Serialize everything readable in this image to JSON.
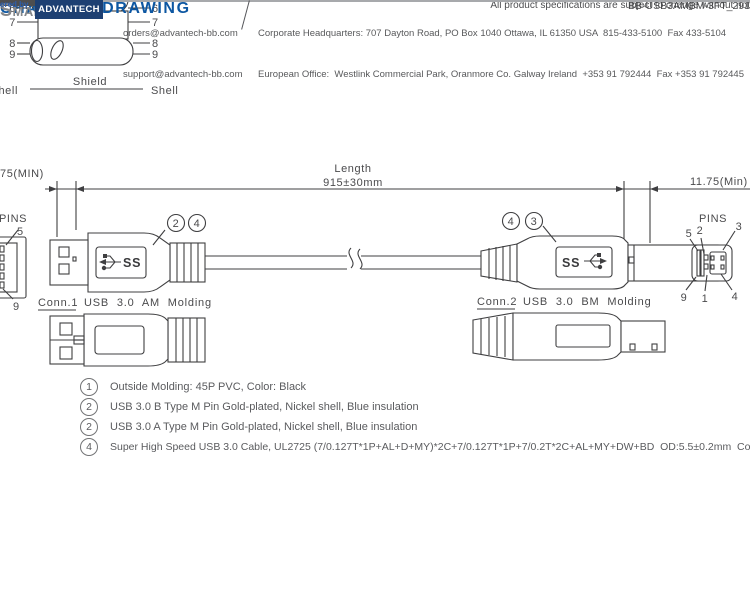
{
  "colors": {
    "heading_blue": "#0d57a2",
    "drawing_line": "#3f3f41",
    "note_text": "#5a5b5e",
    "footer_text": "#58595b",
    "brand_gray": "#85878a",
    "advantech_blue": "#1d3f72",
    "powered_by_blue": "#2c5fae"
  },
  "wiring": {
    "left_pins": [
      "6",
      "7",
      "8",
      "9"
    ],
    "right_pins": [
      "6",
      "7",
      "8",
      "9"
    ],
    "shell_left": "hell",
    "shield_label": "Shield",
    "shell_right": "Shell"
  },
  "header": {
    "title": "CHANICAL DRAWING",
    "unit": "t: mm"
  },
  "dims": {
    "left_min": "75(MIN)",
    "length_label": "Length",
    "length_value": "915±30mm",
    "right_min": "11.75(Min)"
  },
  "conn1": {
    "pins_label": "PINS",
    "pin_top": "5",
    "pin_bottom": "9",
    "callout_a": "2",
    "callout_b": "4",
    "logo": "SS",
    "name": "Conn.1",
    "desc": "USB 3.0 AM Molding"
  },
  "conn2": {
    "pins_label": "PINS",
    "pin_t1": "5",
    "pin_t2": "2",
    "pin_t3": "3",
    "pin_b1": "9",
    "pin_b2": "1",
    "pin_b3": "4",
    "callout_a": "4",
    "callout_b": "3",
    "logo": "SS",
    "name": "Conn.2",
    "desc": "USB 3.0 BM Molding"
  },
  "notes": [
    {
      "num": "1",
      "text": "Outside Molding: 45P PVC, Color: Black"
    },
    {
      "num": "2",
      "text": "USB 3.0 B Type M Pin Gold-plated, Nickel shell, Blue insulation"
    },
    {
      "num": "2",
      "text": "USB 3.0 A Type M Pin Gold-plated, Nickel shell, Blue insulation"
    },
    {
      "num": "4",
      "text": "Super High Speed USB 3.0 Cable, UL2725 (7/0.127T*1P+AL+D+MY)*2C+7/0.127T*1P+7/0.2T*2C+AL+MY+DW+BD  OD:5.5±0.2mm  Color:Black"
    }
  ],
  "disclaimer": {
    "notice": "All product specifications are subject to change without not",
    "doc_id": "BB-USB3AMBM-3FT_291"
  },
  "footer": {
    "brand": "SmartWorx",
    "powered_by": "ered by",
    "advantech": "ADVANTECH",
    "email_orders": "orders@advantech-bb.com",
    "email_support": "support@advantech-bb.com",
    "address_hq": "Corporate Headquarters: 707 Dayton Road, PO Box 1040 Ottawa, IL 61350 USA  815-433-5100  Fax 433-5104",
    "address_eu": "European Office:  Westlink Commercial Park, Oranmore Co. Galway Ireland  +353 91 792444  Fax +353 91 792445"
  }
}
